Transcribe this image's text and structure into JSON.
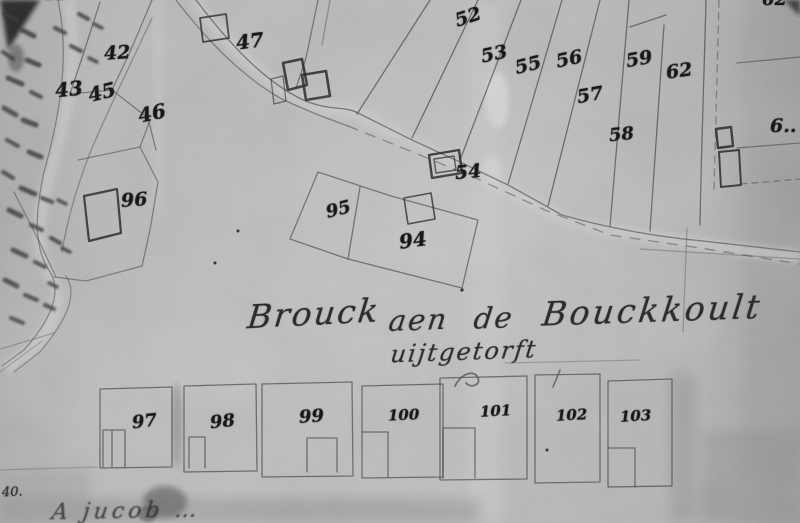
{
  "map": {
    "kind": "historical cadastral map photograph (grayscale)",
    "area_label": {
      "w1": "Brouck",
      "w2": "aen",
      "w3": "de",
      "w4": "Bouckkoult",
      "line2": "uijtgetorft"
    },
    "parcel_labels": {
      "n41_cut": "41",
      "n42_cut": "42",
      "n42": "42",
      "n43": "43",
      "n45": "45",
      "n46": "46",
      "n47": "47",
      "n52": "52",
      "n53": "53",
      "n54": "54",
      "n55": "55",
      "n56": "56",
      "n57": "57",
      "n58": "58",
      "n59": "59",
      "n62": "62",
      "n62_cut": "62",
      "n6_right": "6..",
      "n94": "94",
      "n95": "95",
      "n96": "96",
      "n97": "97",
      "n98": "98",
      "n99": "99",
      "n100": "100",
      "n101": "101",
      "n102": "102",
      "n103": "103"
    },
    "margin_notes": {
      "bottom_left_number": "40.",
      "bottom_fragment": "A jucob …"
    },
    "ink_color": "#1b1b1b",
    "paper_color": "#b5b5b5"
  }
}
